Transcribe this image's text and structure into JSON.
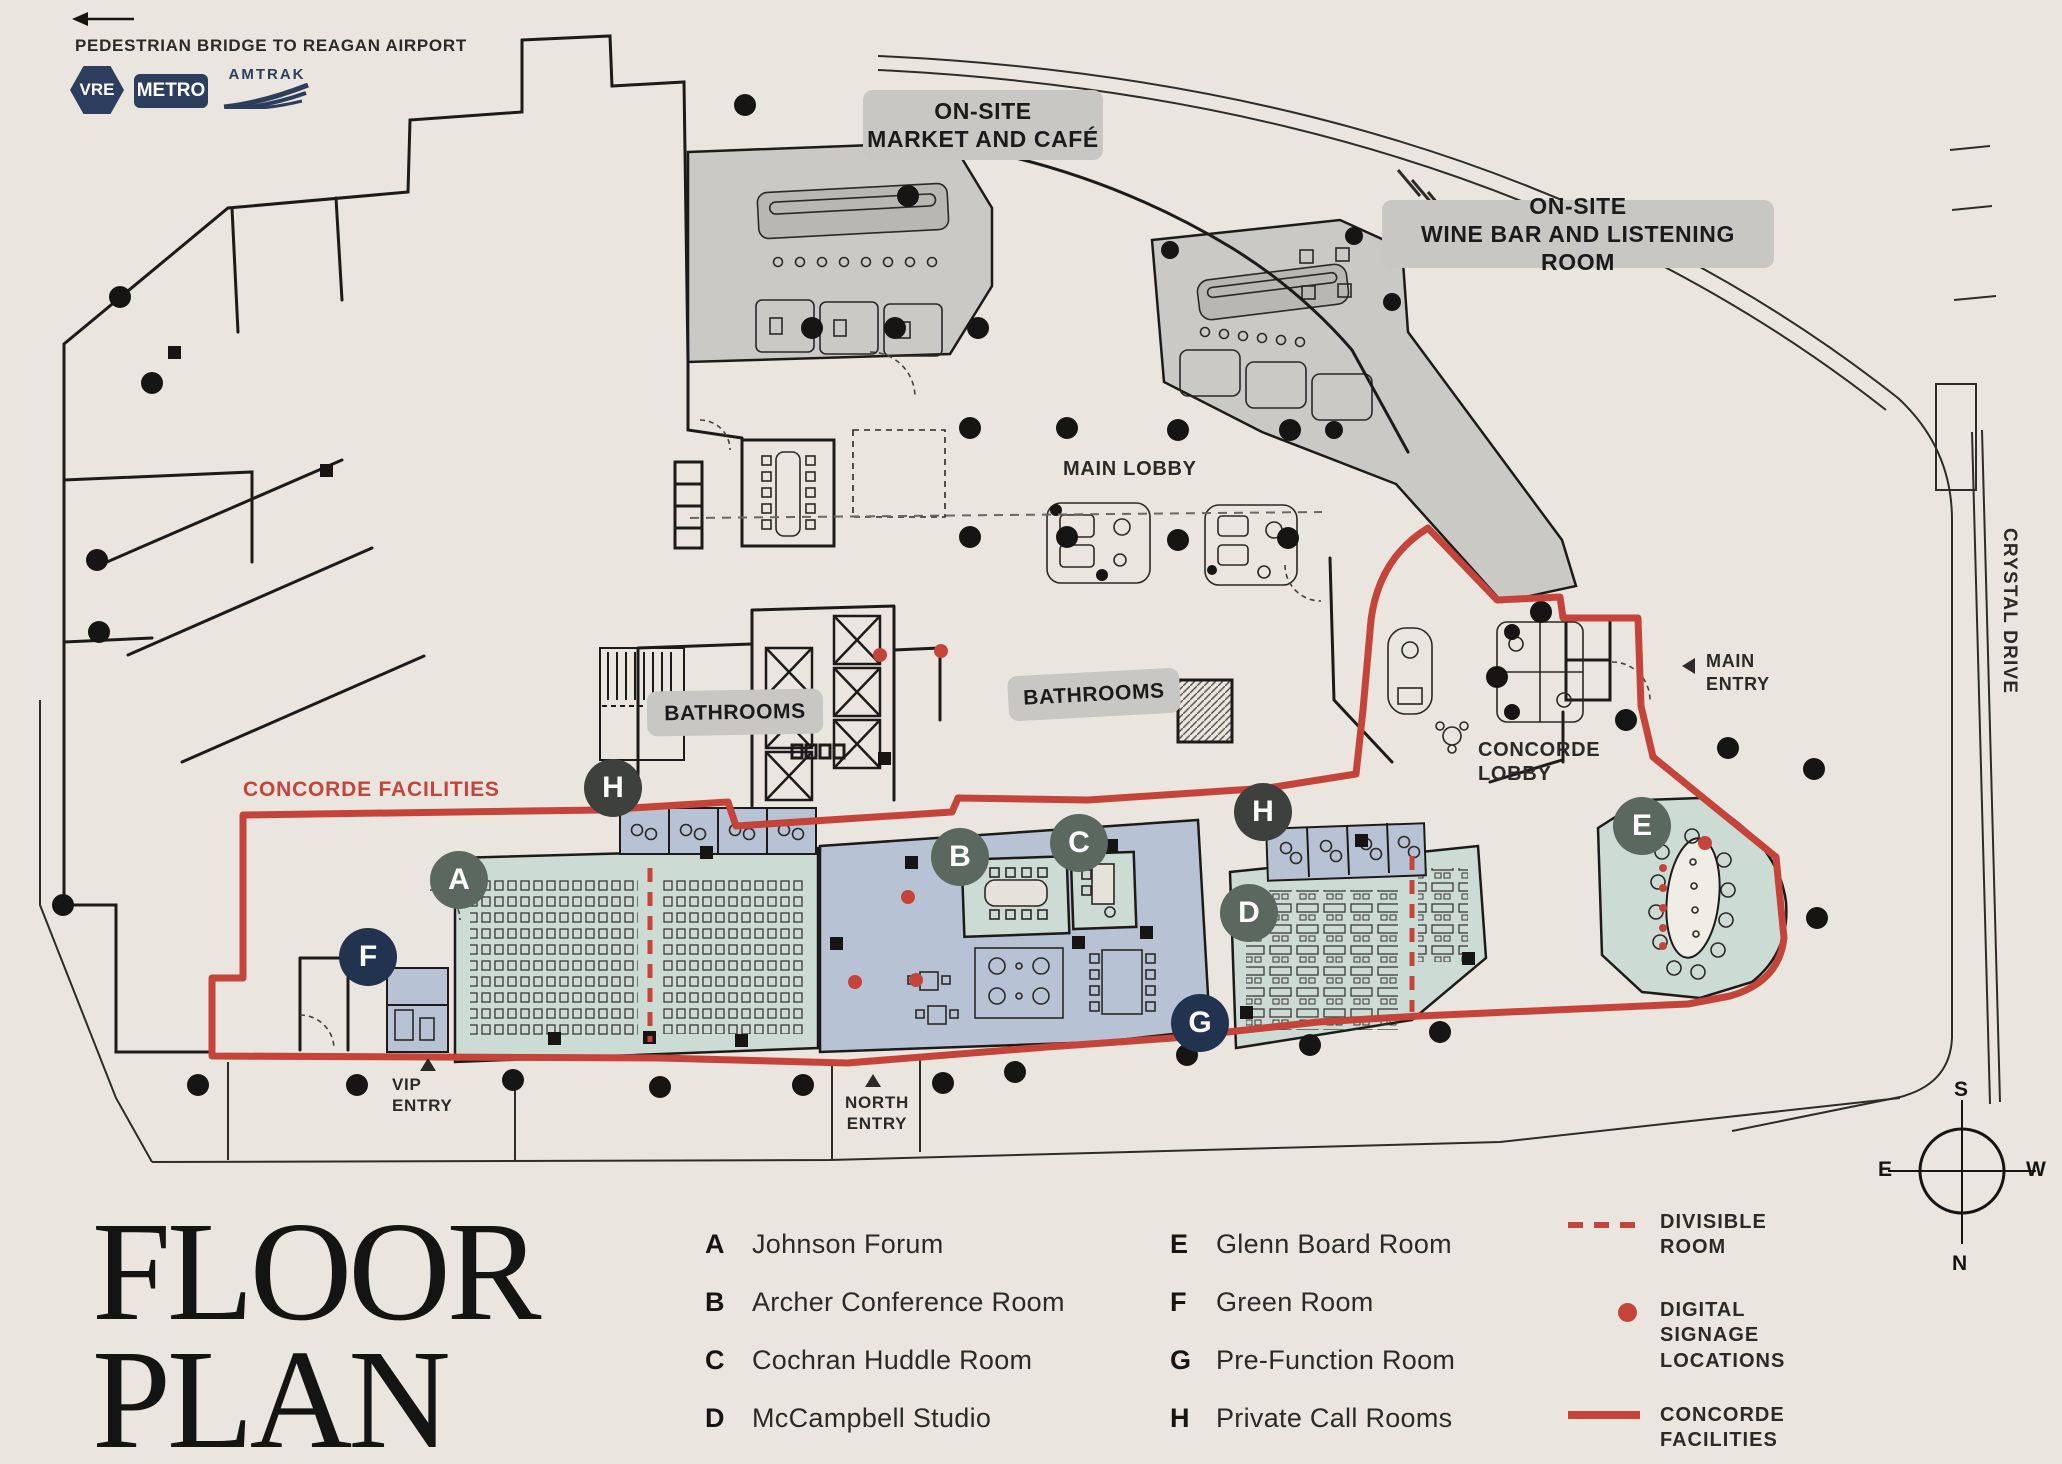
{
  "page": {
    "title_line1": "FLOOR",
    "title_line2": "PLAN"
  },
  "header": {
    "bridge_label": "PEDESTRIAN BRIDGE TO REAGAN AIRPORT",
    "badges": {
      "vre": "VRE",
      "metro": "METRO",
      "amtrak": "AMTRAK"
    }
  },
  "plan": {
    "market_cafe": {
      "line1": "ON-SITE",
      "line2": "MARKET AND CAFÉ"
    },
    "wine_bar": {
      "line1": "ON-SITE",
      "line2": "WINE BAR AND LISTENING ROOM"
    },
    "main_lobby": "MAIN LOBBY",
    "bathrooms_left": "BATHROOMS",
    "bathrooms_right": "BATHROOMS",
    "concorde_facilities": "CONCORDE FACILITIES",
    "concorde_lobby": {
      "line1": "CONCORDE",
      "line2": "LOBBY"
    },
    "main_entry": {
      "line1": "MAIN",
      "line2": "ENTRY"
    },
    "vip_entry": {
      "line1": "VIP",
      "line2": "ENTRY"
    },
    "north_entry": {
      "line1": "NORTH",
      "line2": "ENTRY"
    },
    "crystal_drive": "CRYSTAL DRIVE",
    "markers": {
      "a": "A",
      "b": "B",
      "c": "C",
      "d": "D",
      "e": "E",
      "f": "F",
      "g": "G",
      "h1": "H",
      "h2": "H"
    }
  },
  "compass": {
    "south": "S",
    "east": "E",
    "west": "W",
    "north": "N"
  },
  "legend": {
    "rooms": [
      {
        "letter": "A",
        "name": "Johnson Forum"
      },
      {
        "letter": "B",
        "name": "Archer Conference Room"
      },
      {
        "letter": "C",
        "name": "Cochran Huddle Room"
      },
      {
        "letter": "D",
        "name": "McCampbell Studio"
      },
      {
        "letter": "E",
        "name": "Glenn Board Room"
      },
      {
        "letter": "F",
        "name": "Green Room"
      },
      {
        "letter": "G",
        "name": "Pre-Function Room"
      },
      {
        "letter": "H",
        "name": "Private Call Rooms"
      }
    ],
    "symbols": [
      {
        "line1": "DIVISIBLE",
        "line2": "ROOM",
        "line3": ""
      },
      {
        "line1": "DIGITAL",
        "line2": "SIGNAGE",
        "line3": "LOCATIONS"
      },
      {
        "line1": "CONCORDE",
        "line2": "FACILITIES",
        "line3": ""
      }
    ]
  },
  "colors": {
    "accent_red": "#c5443a",
    "room_teal": "#ccdcd4",
    "room_blue": "#b7c3d5",
    "restaurant_gray": "#cbc9c6",
    "label_gray": "#c8c7c4",
    "marker_sage": "#5b685f",
    "marker_navy": "#21334e",
    "marker_charcoal": "#3e403e",
    "ink": "#1d1b19",
    "background": "#eae6df"
  }
}
